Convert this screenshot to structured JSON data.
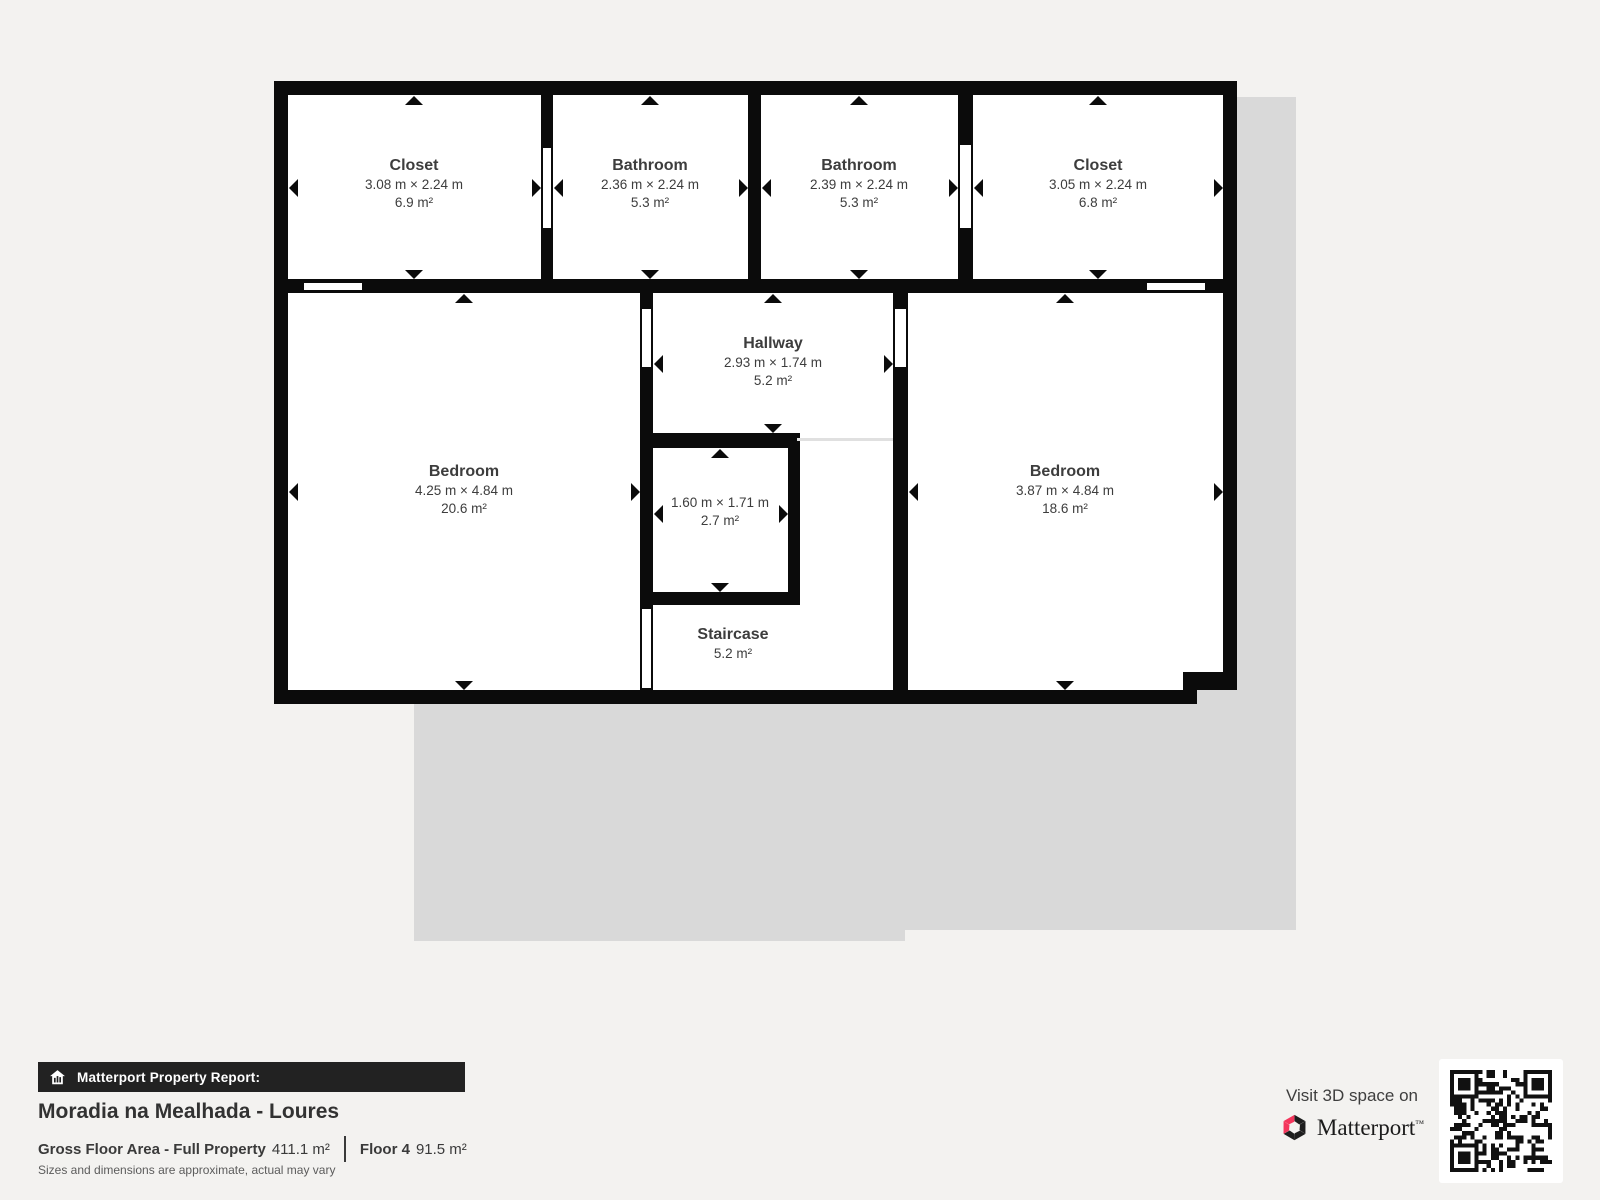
{
  "floor_plan": {
    "rooms": [
      {
        "id": "closet-1",
        "name": "Closet",
        "dims": "3.08 m × 2.24 m",
        "area": "6.9 m²"
      },
      {
        "id": "bathroom-1",
        "name": "Bathroom",
        "dims": "2.36 m × 2.24 m",
        "area": "5.3 m²"
      },
      {
        "id": "bathroom-2",
        "name": "Bathroom",
        "dims": "2.39 m × 2.24 m",
        "area": "5.3 m²"
      },
      {
        "id": "closet-2",
        "name": "Closet",
        "dims": "3.05 m × 2.24 m",
        "area": "6.8 m²"
      },
      {
        "id": "bedroom-left",
        "name": "Bedroom",
        "dims": "4.25 m × 4.84 m",
        "area": "20.6 m²"
      },
      {
        "id": "hallway",
        "name": "Hallway",
        "dims": "2.93 m × 1.74 m",
        "area": "5.2 m²"
      },
      {
        "id": "shaft",
        "name": "",
        "dims": "1.60 m × 1.71 m",
        "area": "2.7 m²"
      },
      {
        "id": "bedroom-right",
        "name": "Bedroom",
        "dims": "3.87 m × 4.84 m",
        "area": "18.6 m²"
      },
      {
        "id": "staircase",
        "name": "Staircase",
        "dims": "",
        "area": "5.2 m²"
      }
    ]
  },
  "report": {
    "banner_label": "Matterport Property Report:",
    "property_title": "Moradia na Mealhada - Loures",
    "gross_label": "Gross Floor Area - Full Property",
    "gross_value": "411.1 m²",
    "floor_label": "Floor 4",
    "floor_value": "91.5 m²",
    "disclaimer": "Sizes and dimensions are approximate, actual may vary"
  },
  "cta": {
    "visit_text": "Visit 3D space on",
    "brand": "Matterport",
    "trademark": "™"
  },
  "icons": {
    "banner_icon": "house-report-icon",
    "brand_icon": "matterport-pinwheel-icon",
    "qr": "qr-code"
  },
  "colors": {
    "background": "#f3f2f0",
    "wall": "#0b0b0b",
    "plan_shadow": "#d9d9d9",
    "brand_pink": "#f4365c",
    "banner_bg": "#222222",
    "label_text": "#3d3d3d"
  }
}
